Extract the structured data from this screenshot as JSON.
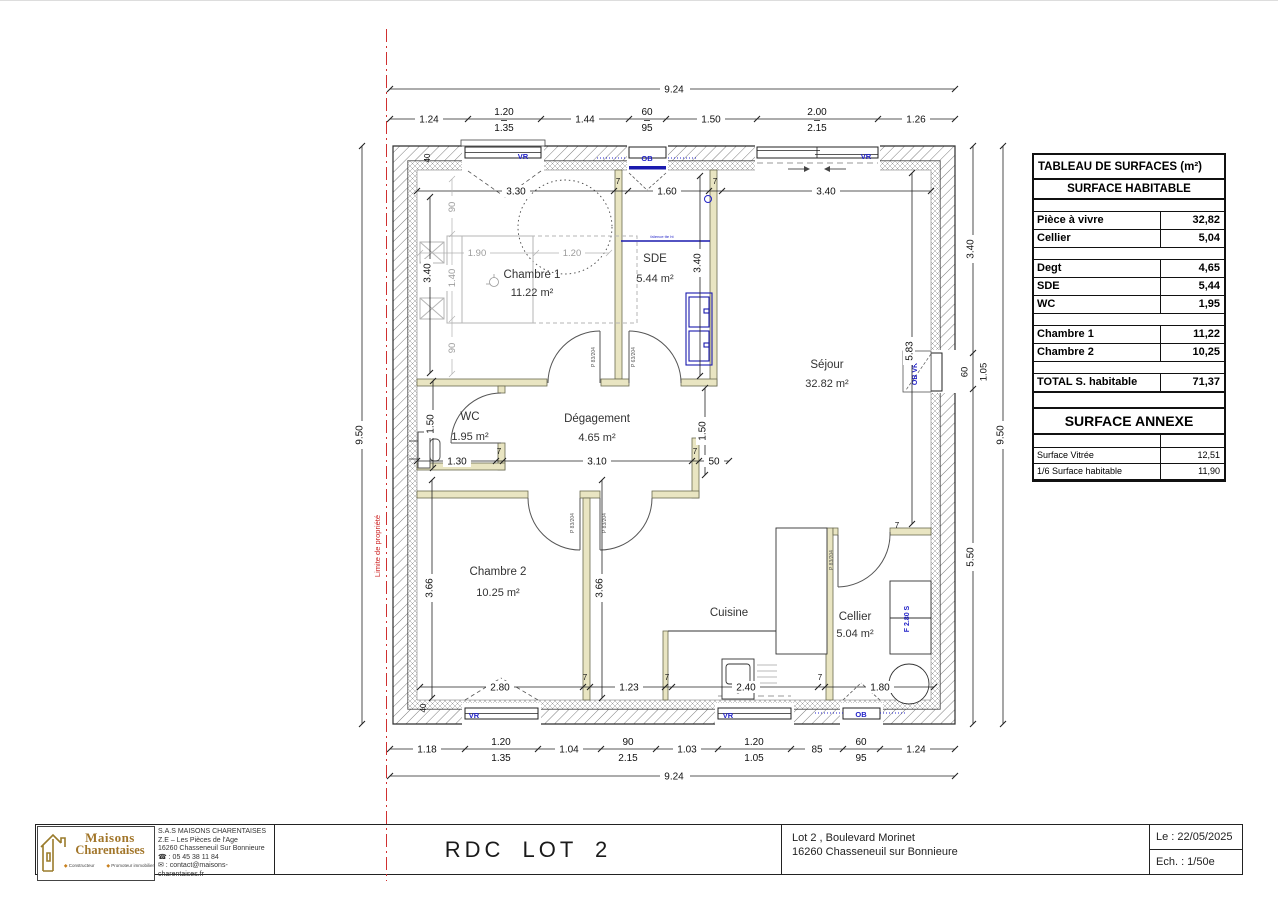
{
  "surface_table": {
    "title": "TABLEAU DE SURFACES (m²)",
    "section1": "SURFACE HABITABLE",
    "rows": [
      {
        "label": "Pièce à vivre",
        "value": "32,82"
      },
      {
        "label": "Cellier",
        "value": "5,04"
      },
      {
        "label": "Degt",
        "value": "4,65"
      },
      {
        "label": "SDE",
        "value": "5,44"
      },
      {
        "label": "WC",
        "value": "1,95"
      },
      {
        "label": "Chambre 1",
        "value": "11,22"
      },
      {
        "label": "Chambre 2",
        "value": "10,25"
      }
    ],
    "total": {
      "label": "TOTAL S. habitable",
      "value": "71,37"
    },
    "section2": "SURFACE ANNEXE",
    "annex_rows": [
      {
        "label": "Surface Vitrée",
        "value": "12,51"
      },
      {
        "label": "1/6 Surface habitable",
        "value": "11,90"
      }
    ]
  },
  "title_block": {
    "logo_line1": "Maisons",
    "logo_line2": "Charentaises",
    "tagline1": "Constructeur",
    "tagline2": "Promoteur immobilier",
    "company": [
      "S.A.S MAISONS CHARENTAISES",
      "Z.E – Les Pièces de l'Age",
      "16260 Chasseneuil Sur Bonnieure",
      "☎ : 05 45 38 11 84",
      "✉ : contact@maisons-charentaises.fr"
    ],
    "drawing_title": "RDC LOT 2",
    "address_line1": "Lot 2 , Boulevard Morinet",
    "address_line2": "16260 Chasseneuil sur Bonnieure",
    "date_label": "Le : 22/05/2025",
    "scale_label": "Ech. : 1/50e"
  },
  "plan": {
    "property_line_label": "Limite de propriété",
    "rooms": {
      "chambre1": {
        "name": "Chambre 1",
        "area": "11.22 m²"
      },
      "sde": {
        "name": "SDE",
        "area": "5.44 m²"
      },
      "sejour": {
        "name": "Séjour",
        "area": "32.82 m²"
      },
      "wc": {
        "name": "WC",
        "area": "1.95 m²"
      },
      "degagement": {
        "name": "Dégagement",
        "area": "4.65 m²"
      },
      "chambre2": {
        "name": "Chambre 2",
        "area": "10.25 m²"
      },
      "cuisine": {
        "name": "Cuisine"
      },
      "cellier": {
        "name": "Cellier",
        "area": "5.04 m²"
      }
    },
    "window_labels": {
      "vr": "VR",
      "ob": "OB",
      "ob_vr": "OB VR"
    },
    "door_labels": {
      "p83": "P 83/204",
      "p63": "P 63/204"
    },
    "fixture_labels": {
      "cellier_f": "F 2.80 S",
      "sde_note": "faïence tte ht"
    },
    "dims": {
      "overall_w": "9.24",
      "overall_h": "9.50",
      "top": [
        "1.24",
        "1.20",
        "1.35",
        "1.44",
        "60",
        "95",
        "1.50",
        "2.00",
        "2.15",
        "1.26"
      ],
      "bottom": [
        "1.18",
        "1.20",
        "1.35",
        "1.04",
        "90",
        "2.15",
        "1.03",
        "1.20",
        "1.05",
        "85",
        "60",
        "95",
        "1.24"
      ],
      "right": [
        "3.40",
        "60",
        "1.05",
        "5.50"
      ],
      "int": {
        "c1_w": "3.30",
        "sde_w": "1.60",
        "sej_w": "3.40",
        "c1_h": "3.40",
        "sde_h": "3.40",
        "sej_h": "5.83",
        "wc_w": "1.30",
        "wc_h": "1.50",
        "deg_w": "3.10",
        "deg_pass": "50",
        "deg_r": "1.50",
        "c2_w": "2.80",
        "c2_h": "3.66",
        "cui_h": "3.66",
        "c2_pass": "1.23",
        "cui_w": "2.40",
        "cel_w": "1.80",
        "wall7": "7",
        "wall40": "40"
      },
      "bed": {
        "w1": "1.90",
        "w2": "1.20",
        "d1": "90",
        "d2": "1.40",
        "d3": "90"
      }
    }
  }
}
